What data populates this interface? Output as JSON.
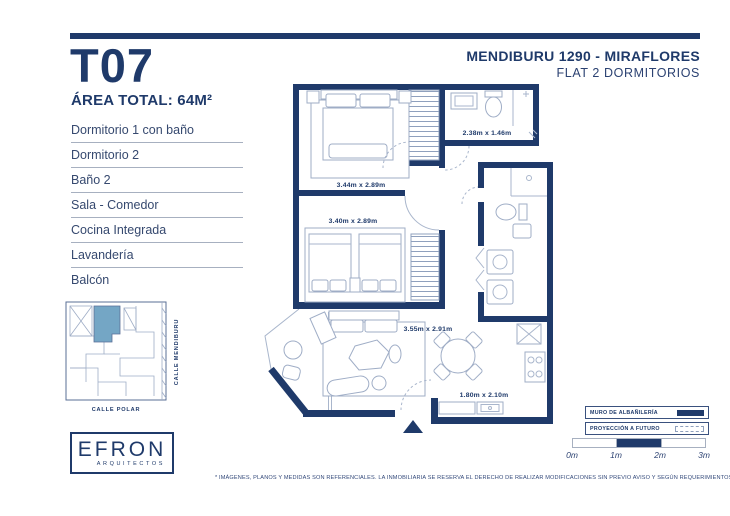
{
  "colors": {
    "navy": "#1f3a6a",
    "highlight": "#74a6c5",
    "thin_line": "#a9b6cc"
  },
  "unit": {
    "code": "T07",
    "area": "ÁREA TOTAL: 64M²"
  },
  "header": {
    "title": "MENDIBURU 1290 - MIRAFLORES",
    "subtitle": "FLAT 2 DORMITORIOS"
  },
  "rooms": [
    "Dormitorio 1 con baño",
    "Dormitorio 2",
    "Baño 2",
    "Sala - Comedor",
    "Cocina Integrada",
    "Lavandería",
    "Balcón"
  ],
  "plan": {
    "dim_dorm1": "3.44m x 2.89m",
    "dim_bath1": "2.38m x 1.46m",
    "dim_dorm2": "3.40m x 2.89m",
    "dim_sala": "3.55m x 2.91m",
    "dim_cocina": "1.80m x 2.10m"
  },
  "site_map": {
    "street_right": "CALLE MENDIBURU",
    "street_bottom": "CALLE POLAR"
  },
  "logo": {
    "name": "EFRON",
    "tagline": "ARQUITECTOS"
  },
  "legend": {
    "wall": "MURO DE ALBAÑILERÍA",
    "future": "PROYECCIÓN A FUTURO"
  },
  "scale_labels": [
    "0m",
    "1m",
    "2m",
    "3m"
  ],
  "disclaimer": "* IMÁGENES, PLANOS Y MEDIDAS SON REFERENCIALES. LA INMOBILIARIA SE RESERVA EL DERECHO DE REALIZAR MODIFICACIONES SIN PREVIO AVISO Y SEGÚN REQUERIMIENTOS DEL PROYECTO."
}
